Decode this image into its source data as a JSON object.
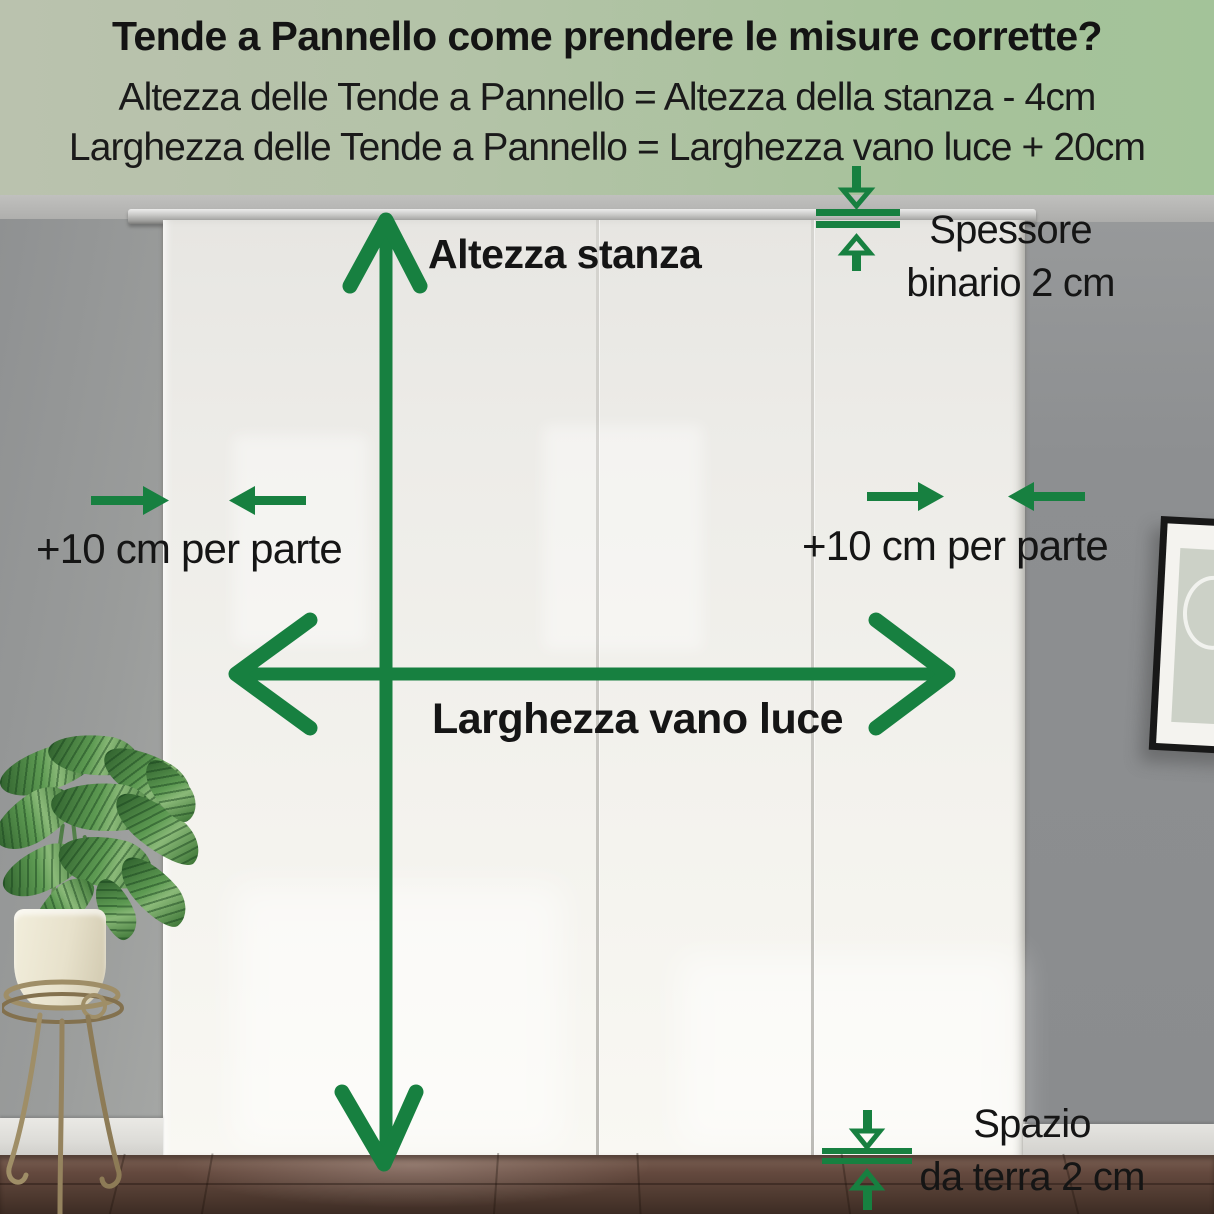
{
  "banner": {
    "title": "Tende a Pannello come prendere le misure corrette?",
    "formula_height": "Altezza delle Tende a Pannello = Altezza della stanza - 4cm",
    "formula_width": "Larghezza delle Tende a Pannello = Larghezza vano luce + 20cm",
    "background_left": "#bac2ae",
    "background_right": "#a3c399",
    "text_color": "#151515"
  },
  "labels": {
    "room_height": "Altezza stanza",
    "opening_width": "Larghezza vano luce",
    "margin_left": "+10 cm per parte",
    "margin_right": "+10 cm per parte",
    "rail_thickness_line1": "Spessore",
    "rail_thickness_line2": "binario 2 cm",
    "floor_gap_line1": "Spazio",
    "floor_gap_line2": "da terra 2 cm"
  },
  "colors": {
    "annotation_green": "#178040",
    "label_text": "#151515",
    "wall_gray": "#939596",
    "curtain_white": "#f2f1ec",
    "floor_brown": "#5a443a",
    "banner_green": "#aec3a0"
  }
}
